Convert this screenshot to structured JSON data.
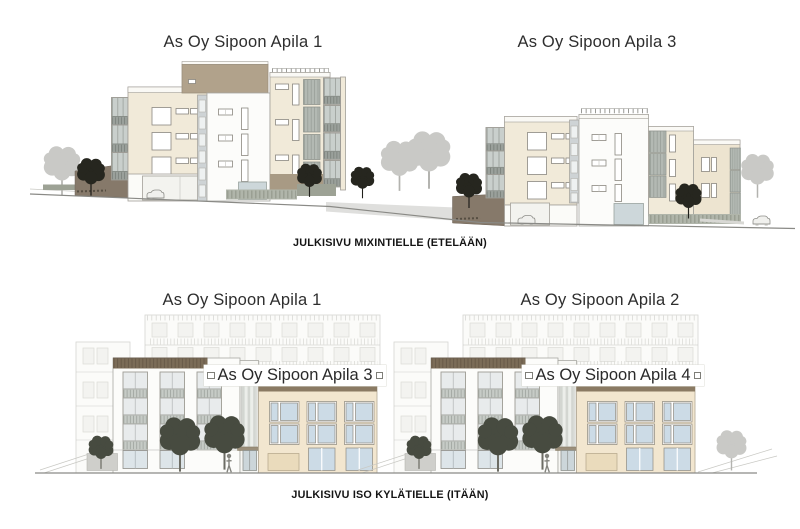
{
  "sheet": {
    "south": {
      "left_title": "As Oy Sipoon Apila 1",
      "right_title": "As Oy Sipoon Apila 3",
      "caption": "JULKISIVU MIXINTIELLE (ETELÄÄN)"
    },
    "east": {
      "left_title": "As Oy Sipoon Apila 1",
      "right_title": "As Oy Sipoon Apila 2",
      "left_facade_label": "As Oy Sipoon Apila 3",
      "right_facade_label": "As Oy Sipoon Apila 4",
      "caption": "JULKISIVU ISO KYLÄTIELLE (ITÄÄN)"
    }
  },
  "colors": {
    "cream": "#f1ead9",
    "cream2": "#ede4d0",
    "taupe": "#b1a28b",
    "beige": "#f2e6cf",
    "cornice": "#7b6c57",
    "band": "#8a7a63",
    "dark_wall": "#86796a",
    "window": "#ccdbe6",
    "ink": "#2e2e2e"
  }
}
